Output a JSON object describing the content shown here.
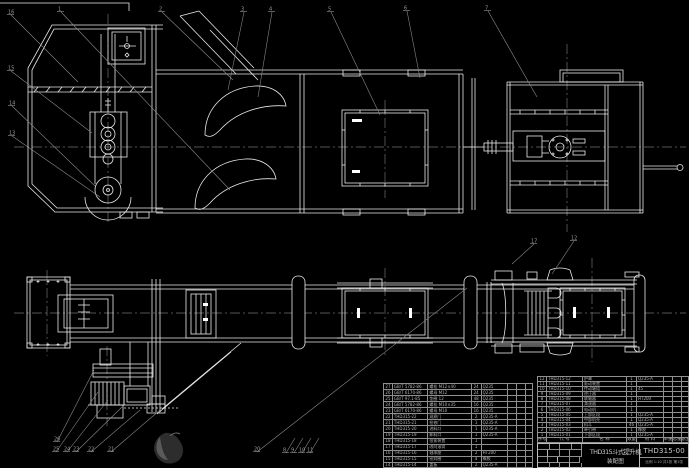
{
  "title_block": {
    "product_title": "THD315斗式提升机",
    "sheet_name": "装配图",
    "drawing_number": "THD315-00",
    "sheet_info": "比例 1:10  共1张 第1张"
  },
  "colors": {
    "background": "#000000",
    "line": "#e9e9e9",
    "centerline": "#6f6f6f",
    "leader": "#8a8a8a",
    "table_text": "#b4b4b4"
  },
  "bom_right": {
    "header": [
      "序号",
      "代  号",
      "名  称",
      "数量",
      "材  料",
      "单重",
      "总重",
      "备注"
    ],
    "rows": [
      [
        "12",
        "THD315-12",
        "护罩",
        "1",
        "Q235-A",
        "",
        "",
        " "
      ],
      [
        "11",
        "THD315-11",
        "驱动装置",
        "1",
        "",
        "",
        "",
        " "
      ],
      [
        "10",
        "THD315-10",
        "传动轴组",
        "1",
        "45",
        "",
        "",
        " "
      ],
      [
        "9",
        "THD315-09",
        "逆止器",
        "1",
        "",
        "",
        "",
        " "
      ],
      [
        "8",
        "THD315-08",
        "联轴器",
        "1",
        "HT200",
        "",
        "",
        " "
      ],
      [
        "7",
        "THD315-07",
        "减速器",
        "1",
        "",
        "",
        "",
        " "
      ],
      [
        "6",
        "THD315-06",
        "电动机",
        "1",
        "",
        "",
        "",
        " "
      ],
      [
        "5",
        "THD315-05",
        "上部区段",
        "1",
        "Q235-A",
        "",
        "",
        " "
      ],
      [
        "4",
        "THD315-04",
        "中部机壳",
        "1",
        "Q235-A",
        "",
        "",
        " "
      ],
      [
        "3",
        "THD315-03",
        "料斗",
        "46",
        "Q235-A",
        "",
        "",
        " "
      ],
      [
        "2",
        "THD315-02",
        "牵引带",
        "1",
        "橡胶",
        "",
        "",
        " "
      ],
      [
        "1",
        "THD315-01",
        "下部区段",
        "1",
        "Q235-A",
        "",
        "",
        " "
      ]
    ]
  },
  "bom_left": {
    "rows": [
      [
        "27",
        "GB/T 5782-86",
        "螺栓 M12×40",
        "24",
        "Q235",
        "",
        "",
        " "
      ],
      [
        "26",
        "GB/T 6170-86",
        "螺母 M12",
        "24",
        "Q235",
        "",
        "",
        " "
      ],
      [
        "25",
        "GB/T 97.1-85",
        "垫圈 12",
        "48",
        "Q235",
        "",
        "",
        " "
      ],
      [
        "24",
        "GB/T 5782-86",
        "螺栓 M10×35",
        "16",
        "Q235",
        "",
        "",
        " "
      ],
      [
        "23",
        "GB/T 6170-86",
        "螺母 M10",
        "16",
        "Q235",
        "",
        "",
        " "
      ],
      [
        "22",
        "THD315-22",
        "观察门",
        "2",
        "Q235-A",
        "",
        "",
        " "
      ],
      [
        "21",
        "THD315-21",
        "检修门",
        "1",
        "Q235-A",
        "",
        "",
        " "
      ],
      [
        "20",
        "THD315-20",
        "进料口",
        "1",
        "Q235-A",
        "",
        "",
        " "
      ],
      [
        "19",
        "THD315-19",
        "卸料口",
        "1",
        "Q235-A",
        "",
        "",
        " "
      ],
      [
        "18",
        "THD315-18",
        "张紧装置",
        "1",
        "",
        "",
        "",
        " "
      ],
      [
        "17",
        "THD315-17",
        "改向滚筒",
        "1",
        "",
        "",
        "",
        " "
      ],
      [
        "16",
        "THD315-16",
        "轴承座",
        "2",
        "HT200",
        "",
        "",
        " "
      ],
      [
        "15",
        "THD315-15",
        "密封圈",
        "4",
        "橡胶",
        "",
        "",
        " "
      ],
      [
        "14",
        "THD315-14",
        "盖板",
        "2",
        "Q235-A",
        "",
        "",
        " "
      ]
    ]
  },
  "callouts": [
    {
      "label": "1",
      "x": 58,
      "y": 9,
      "lx": 230,
      "ly": 190
    },
    {
      "label": "2",
      "x": 159,
      "y": 9,
      "lx": 233,
      "ly": 80
    },
    {
      "label": "3",
      "x": 241,
      "y": 9,
      "lx": 228,
      "ly": 90
    },
    {
      "label": "4",
      "x": 269,
      "y": 9,
      "lx": 258,
      "ly": 97
    },
    {
      "label": "5",
      "x": 328,
      "y": 9,
      "lx": 380,
      "ly": 115
    },
    {
      "label": "6",
      "x": 404,
      "y": 8,
      "lx": 420,
      "ly": 78
    },
    {
      "label": "7",
      "x": 485,
      "y": 8,
      "lx": 537,
      "ly": 97
    },
    {
      "label": "16",
      "x": 8,
      "y": 12,
      "lx": 78,
      "ly": 82
    },
    {
      "label": "15",
      "x": 8,
      "y": 68,
      "lx": 92,
      "ly": 133
    },
    {
      "label": "14",
      "x": 9,
      "y": 103,
      "lx": 95,
      "ly": 186
    },
    {
      "label": "13",
      "x": 9,
      "y": 133,
      "lx": 100,
      "ly": 197
    },
    {
      "label": "26",
      "x": 54,
      "y": 439,
      "lx": 94,
      "ly": 370
    },
    {
      "label": "25",
      "x": 53,
      "y": 449,
      "lx": 98,
      "ly": 392
    },
    {
      "label": "24",
      "x": 64,
      "y": 449,
      "lx": 108,
      "ly": 400
    },
    {
      "label": "23",
      "x": 73,
      "y": 449,
      "lx": 122,
      "ly": 407
    },
    {
      "label": "22",
      "x": 88,
      "y": 449,
      "lx": 140,
      "ly": 410
    },
    {
      "label": "21",
      "x": 108,
      "y": 449,
      "lx": 160,
      "ly": 410
    },
    {
      "label": "20",
      "x": 254,
      "y": 449,
      "lx": 467,
      "ly": 288
    },
    {
      "label": "8",
      "x": 283,
      "y": 450,
      "lx": 295,
      "ly": 438
    },
    {
      "label": "9",
      "x": 291,
      "y": 450,
      "lx": 303,
      "ly": 438
    },
    {
      "label": "10",
      "x": 299,
      "y": 450,
      "lx": 311,
      "ly": 438
    },
    {
      "label": "11",
      "x": 307,
      "y": 450,
      "lx": 319,
      "ly": 438
    },
    {
      "label": "12",
      "x": 571,
      "y": 238,
      "lx": 552,
      "ly": 274
    },
    {
      "label": "17",
      "x": 531,
      "y": 241,
      "lx": 512,
      "ly": 264
    }
  ]
}
